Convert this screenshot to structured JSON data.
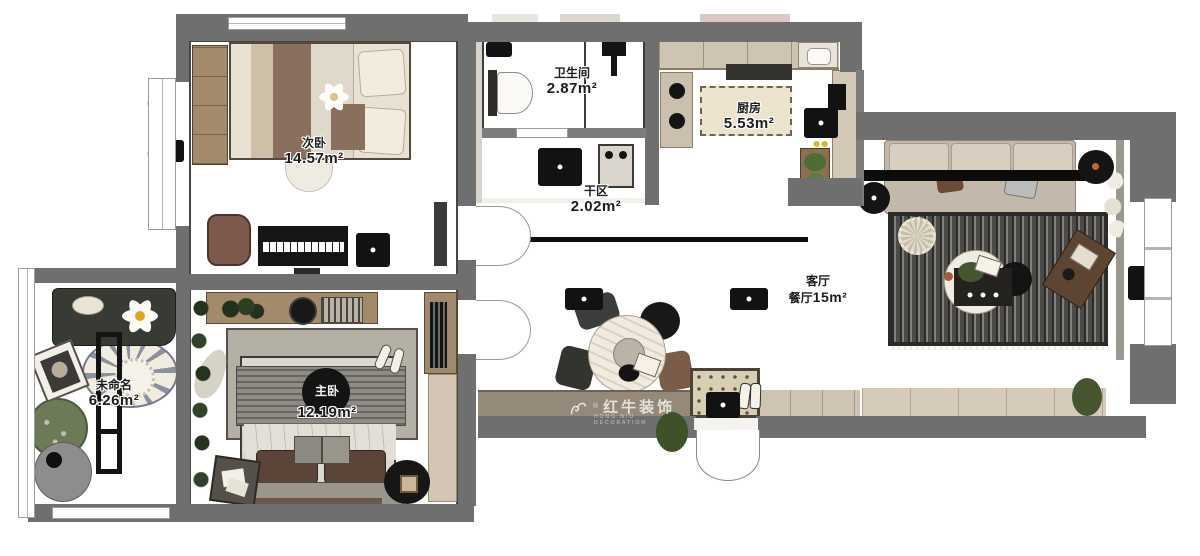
{
  "watermark": {
    "brand": "红牛装饰",
    "reg": "®",
    "sub": "HONG NIU DECORATION"
  },
  "rooms": [
    {
      "key": "ciwo",
      "name": "次卧",
      "area": "14.57m²"
    },
    {
      "key": "weishengjian",
      "name": "卫生间",
      "area": "2.87m²"
    },
    {
      "key": "chufang",
      "name": "厨房",
      "area": "5.53m²"
    },
    {
      "key": "ganqu",
      "name": "干区",
      "area": "2.02m²"
    },
    {
      "key": "keting",
      "name": "客厅",
      "name2": "餐厅",
      "area": "15m²"
    },
    {
      "key": "weimingming",
      "name": "未命名",
      "area": "6.26m²"
    },
    {
      "key": "zhuwo",
      "name": "主卧",
      "area": "12.19m²"
    }
  ],
  "colors": {
    "wall": "#6f6f6f",
    "wood_floor": "#8d8176",
    "living_tile": "#d8d2c9",
    "bath_tile": "#b3aea6",
    "marble": "#f3f1ec",
    "rug_dark": "#5f5d57",
    "accent_orange": "#c2662c"
  }
}
